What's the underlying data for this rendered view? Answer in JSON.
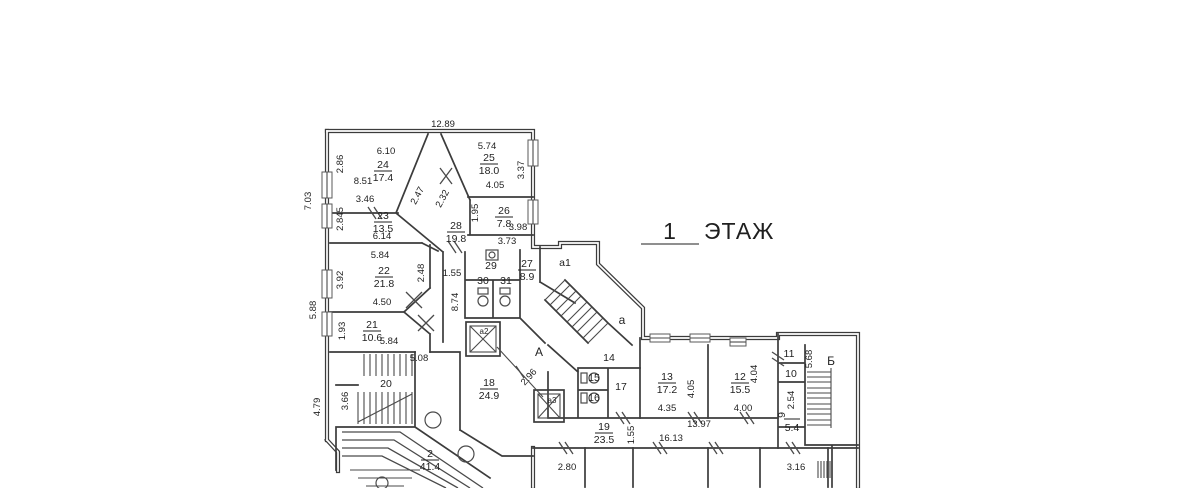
{
  "title": {
    "number": "1",
    "word": "ЭТАЖ"
  },
  "rooms": [
    {
      "number": "24",
      "area": "17.4"
    },
    {
      "number": "25",
      "area": "18.0"
    },
    {
      "number": "23",
      "area": "13.5"
    },
    {
      "number": "26",
      "area": "7.8"
    },
    {
      "number": "28",
      "area": "19.8"
    },
    {
      "number": "22",
      "area": "21.8"
    },
    {
      "number": "27",
      "area": "8.9"
    },
    {
      "number": "21",
      "area": "10.6"
    },
    {
      "number": "18",
      "area": "24.9"
    },
    {
      "number": "2",
      "area": "41.4"
    },
    {
      "number": "13",
      "area": "17.2"
    },
    {
      "number": "12",
      "area": "15.5"
    },
    {
      "number": "19",
      "area": "23.5"
    },
    {
      "number": "9",
      "area": "5.4"
    }
  ],
  "plain_rooms": [
    "29",
    "30",
    "31",
    "20",
    "14",
    "15",
    "16",
    "17",
    "11",
    "10"
  ],
  "letters": [
    "А",
    "Б",
    "а",
    "а1",
    "а2",
    "а3"
  ],
  "dims": [
    "12.89",
    "7.03",
    "2.86",
    "6.10",
    "8.51",
    "3.46",
    "2.47",
    "2.32",
    "5.74",
    "3.37",
    "4.05",
    "1.95",
    "3.98",
    "3.73",
    "2.845",
    "6.14",
    "5.84",
    "3.92",
    "2.48",
    "4.50",
    "1.55",
    "8.74",
    "5.88",
    "1.93",
    "5.84",
    "5.08",
    "3.66",
    "4.79",
    "2.96",
    "2.80",
    "4.35",
    "4.05",
    "4.00",
    "4.04",
    "13.97",
    "16.13",
    "1.55",
    "5.68",
    "2.54",
    "3.16"
  ]
}
